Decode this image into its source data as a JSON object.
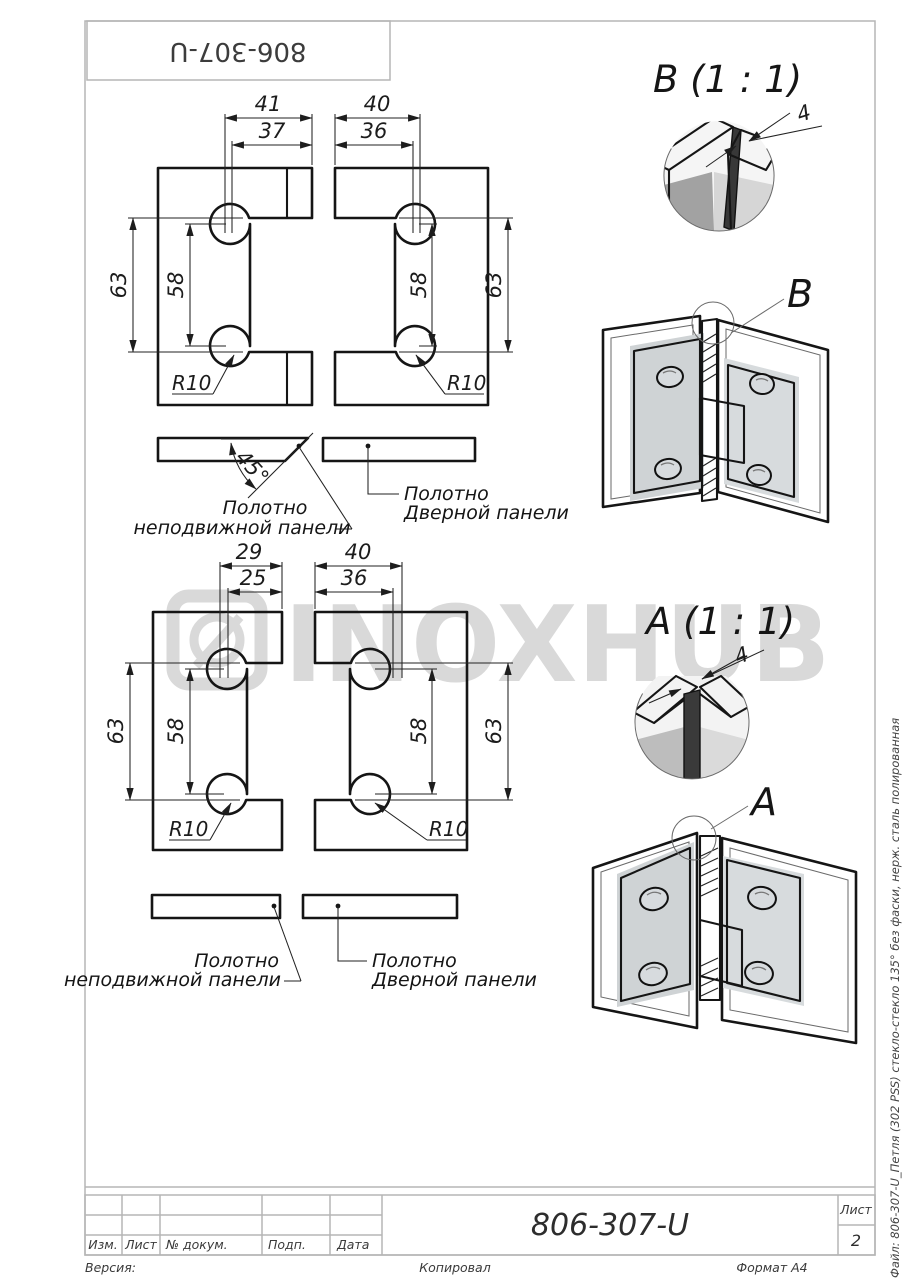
{
  "sheet": {
    "designation_top_rotated": "806-307-U",
    "watermark_text": "INOXHUB",
    "side_note": "Файл: 806-307-U_Петля (302 PSS) стекло-стекло 135°  без фаски, нерж. сталь полированная"
  },
  "top_drawing": {
    "left_piece": {
      "outer_width": "41",
      "inner_width": "37",
      "outer_height": "63",
      "inner_height": "58",
      "corner_radius": "R10"
    },
    "right_piece": {
      "outer_width": "40",
      "inner_width": "36",
      "outer_height": "63",
      "inner_height": "58",
      "corner_radius": "R10"
    },
    "bevel_angle": "45°",
    "fixed_panel_label": [
      "Полотно",
      "неподвижной панели"
    ],
    "door_panel_label": [
      "Полотно",
      "Дверной панели"
    ]
  },
  "bottom_drawing": {
    "left_piece": {
      "outer_width": "29",
      "inner_width": "25",
      "outer_height": "63",
      "inner_height": "58",
      "corner_radius": "R10"
    },
    "right_piece": {
      "outer_width": "40",
      "inner_width": "36",
      "outer_height": "63",
      "inner_height": "58",
      "corner_radius": "R10"
    },
    "fixed_panel_label": [
      "Полотно",
      "неподвижной панели"
    ],
    "door_panel_label": [
      "Полотно",
      "Дверной панели"
    ]
  },
  "details": {
    "view_b": {
      "title": "B (1 : 1)",
      "gap": "4",
      "marker": "B"
    },
    "view_a": {
      "title": "A (1 : 1)",
      "gap": "4",
      "marker": "A"
    }
  },
  "title_block": {
    "designation": "806-307-U",
    "sheet_label": "Лист",
    "sheet_number": "2",
    "columns": {
      "izm": "Изм.",
      "list": "Лист",
      "doc": "№ докум.",
      "sign": "Подп.",
      "date": "Дата"
    },
    "version_label": "Версия:",
    "copied_label": "Копировал",
    "format_label": "Формат A4"
  }
}
